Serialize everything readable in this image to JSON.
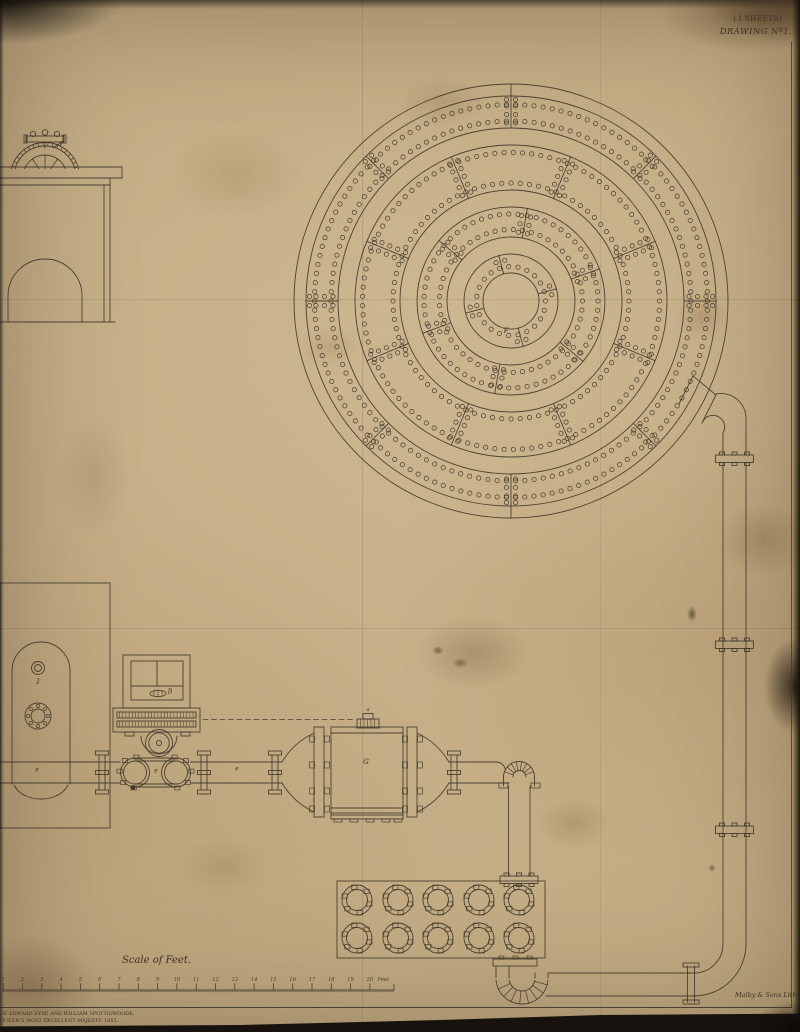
{
  "sheet": {
    "sheets_note": "(3 SHEETS)",
    "drawing_no": "DRAWING Nº1.",
    "litho_credit": "Malby & Sons Lith",
    "imprint_line1": "GE EDWARD EYRE AND WILLIAM SPOTTISWOODE,",
    "imprint_line2": "QUEEN'S MOST EXCELLENT MAJESTY. 1855."
  },
  "scale_bar": {
    "title": "Scale of Feet.",
    "unit_label": "Feet",
    "tick_labels": [
      "1",
      "2",
      "3",
      "4",
      "5",
      "6",
      "7",
      "8",
      "9",
      "10",
      "11",
      "12",
      "13",
      "14",
      "15",
      "16",
      "17",
      "18",
      "19",
      "20"
    ]
  },
  "part_labels": {
    "plan_center": "F",
    "machine": "B",
    "tank": "G",
    "vessel": "I",
    "vessel_pipe": "e",
    "pump_chamber": "e",
    "mid_pipe": "e",
    "tank_top": "a"
  },
  "colors": {
    "paper": "#c8b189",
    "ink": "#3f3527",
    "edge_shadow": "#17120c"
  }
}
